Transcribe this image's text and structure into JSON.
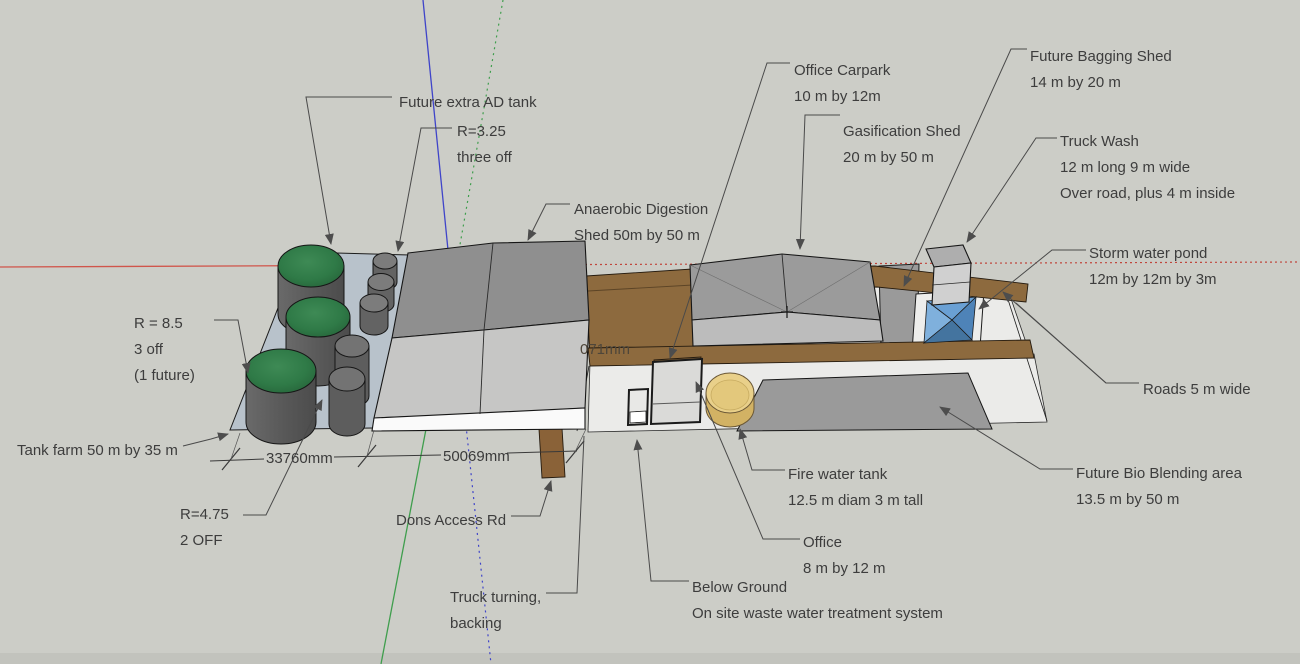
{
  "scene": {
    "app": "3d-model-viewport",
    "colors": {
      "background": "#cccdc7",
      "bottom_bar": "#c2c3bd",
      "axis_red": "#cc4438",
      "axis_green": "#3f9e4d",
      "axis_blue": "#3f44c9",
      "road_brown": "#8d6a3e",
      "tank_top_green": "#2f7a47",
      "pond_blue": "#6aa0d4",
      "fire_tank_yellow": "#e9d08a",
      "pad_blue_gray": "#b8c2cb"
    }
  },
  "annotations": {
    "future_extra_ad_tank": {
      "l1": "Future extra AD tank"
    },
    "r_3_25": {
      "l1": "R=3.25",
      "l2": "three off"
    },
    "anaerobic": {
      "l1": "Anaerobic Digestion",
      "l2": "Shed 50m by 50 m"
    },
    "office_carpark": {
      "l1": "Office Carpark",
      "l2": "10 m by 12m"
    },
    "gasification": {
      "l1": "Gasification Shed",
      "l2": "20 m by 50 m"
    },
    "future_bagging": {
      "l1": "Future Bagging Shed",
      "l2": "14 m by 20 m"
    },
    "truck_wash": {
      "l1": "Truck Wash",
      "l2": "12 m long 9 m wide",
      "l3": "Over road, plus 4 m inside"
    },
    "storm_pond": {
      "l1": "Storm water pond",
      "l2": "12m by 12m by 3m"
    },
    "roads": {
      "l1": "Roads 5 m wide"
    },
    "bio_blending": {
      "l1": "Future Bio Blending area",
      "l2": "13.5 m by 50 m"
    },
    "fire_tank": {
      "l1": "Fire water tank",
      "l2": "12.5 m diam 3 m tall"
    },
    "office": {
      "l1": "Office",
      "l2": "8 m by 12 m"
    },
    "below_ground": {
      "l1": "Below Ground",
      "l2": "On site waste water treatment system"
    },
    "truck_turning": {
      "l1": "Truck turning,",
      "l2": "backing"
    },
    "dons_access": {
      "l1": "Dons Access Rd"
    },
    "r_8_5": {
      "l1": "R = 8.5",
      "l2": "3 off",
      "l3": "(1 future)"
    },
    "tank_farm": {
      "l1": "Tank farm 50 m by 35 m"
    },
    "r_4_75": {
      "l1": "R=4.75",
      "l2": "2 OFF"
    }
  },
  "dims": {
    "d33760": "33760mm",
    "d50069": "50069mm",
    "d071": "071mm"
  }
}
